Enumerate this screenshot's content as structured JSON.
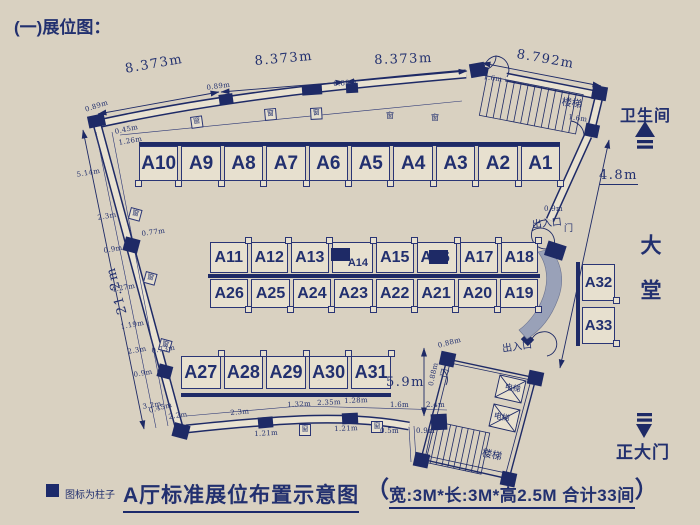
{
  "title": "(一)展位图：",
  "booths": {
    "top_row": [
      "A10",
      "A9",
      "A8",
      "A7",
      "A6",
      "A5",
      "A4",
      "A3",
      "A2",
      "A1"
    ],
    "mid_upper": [
      "A11",
      "A12",
      "A13",
      "A14",
      "A15",
      "A16",
      "A17",
      "A18"
    ],
    "mid_lower": [
      "A26",
      "A25",
      "A24",
      "A23",
      "A22",
      "A21",
      "A20",
      "A19"
    ],
    "bottom_row": [
      "A27",
      "A28",
      "A29",
      "A30",
      "A31"
    ],
    "side_col": [
      "A32",
      "A33"
    ]
  },
  "rooms": {
    "stairs": "楼梯",
    "elevator": "电梯",
    "restroom": "卫生间",
    "lobby": "大堂",
    "main_gate": "正大门",
    "entrance": "出入口",
    "door": "门",
    "window": "窗"
  },
  "dims": {
    "top_spans": [
      "8.373m",
      "8.373m",
      "8.373m",
      "8.792m"
    ],
    "left_total": "21.2m",
    "right_wall": "4.8m",
    "bottom_inner": "5.9m",
    "small": [
      "0.89m",
      "0.89m",
      "0.89m",
      "0.45m",
      "1.26m",
      "5.14m",
      "2.3m",
      "0.9m",
      "4.27m",
      "1.19m",
      "2.3m",
      "0.9m",
      "3.2m",
      "0.77m",
      "0.73m",
      "0.45m",
      "2.2m",
      "2.3m",
      "1.32m",
      "2.35m",
      "1.28m",
      "1.6m",
      "2.4m",
      "1.21m",
      "1.21m",
      "0.5m",
      "0.9m",
      "1.6m",
      "1.6m",
      "0.9m",
      "0.88m",
      "0.88m"
    ]
  },
  "legend": {
    "text": "图标为柱子"
  },
  "caption": {
    "main": "A厅标准展位布置示意图",
    "open": "（",
    "body": "宽:3M*长:3M*高2.5M  合计33间",
    "close": "）"
  },
  "colors": {
    "line": "#1e2a66",
    "bg": "#d9d1c1",
    "booth_fill": "#e7e0cf",
    "shade": "#99a1b8"
  }
}
